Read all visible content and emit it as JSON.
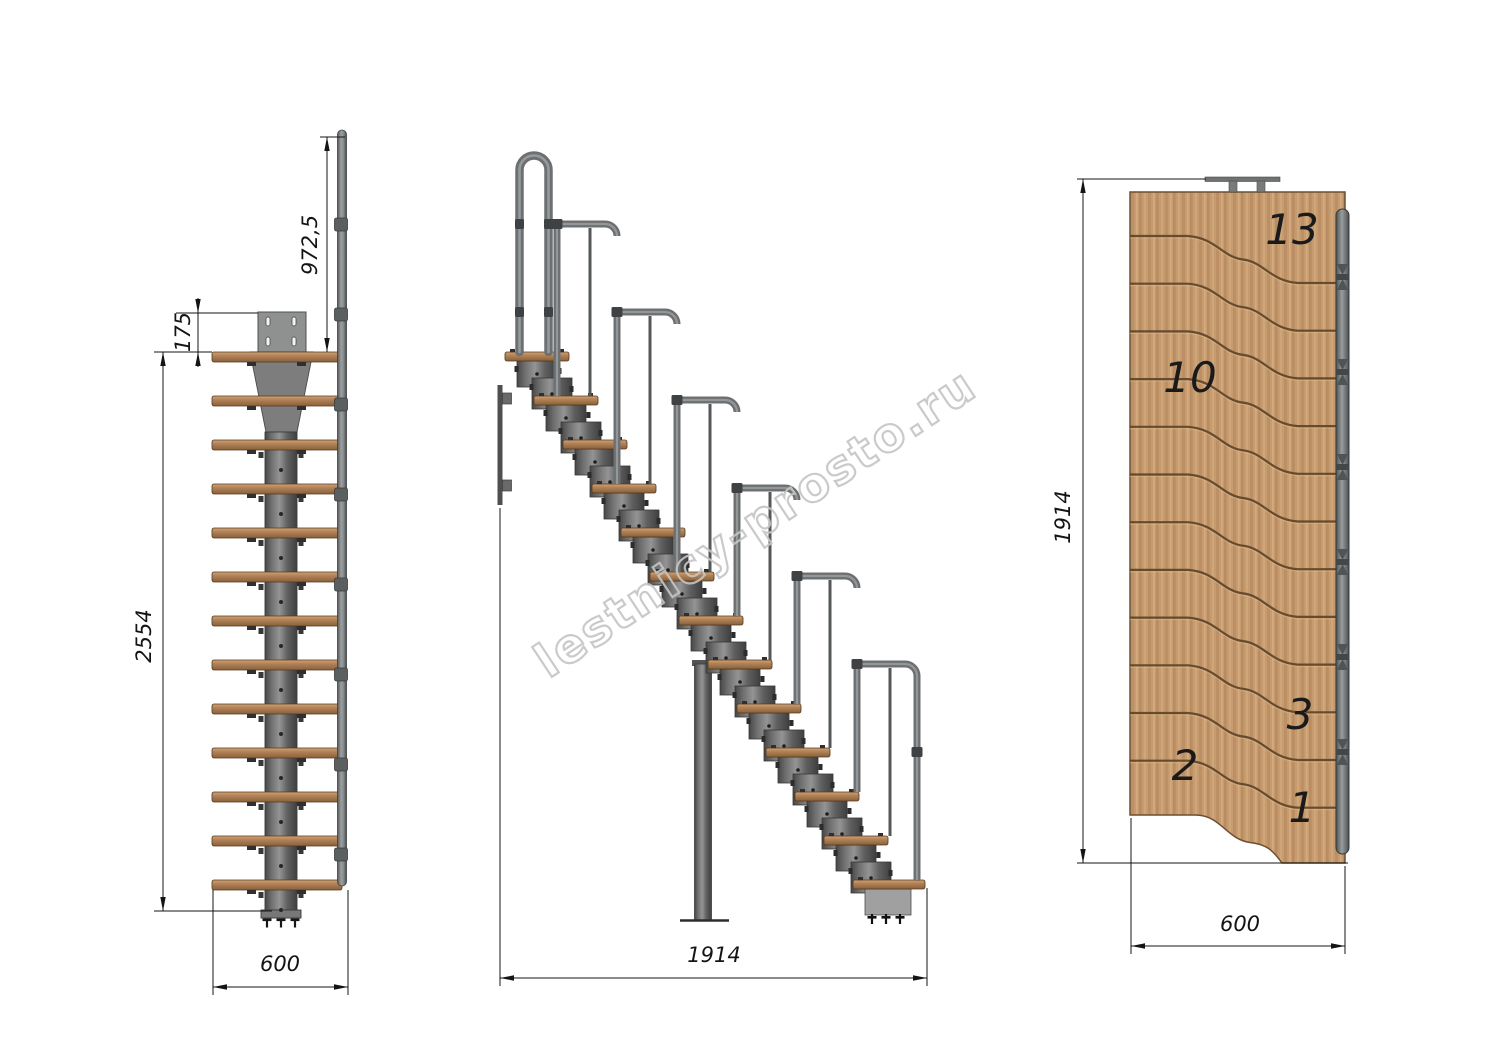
{
  "watermark": "lestnicy-prosto.ru",
  "structure": {
    "steps": 13,
    "handrail_joints": 6
  },
  "front_view": {
    "dim_handrail_height": "972,5",
    "dim_top_module": "175",
    "dim_total_height": "2554",
    "dim_width": "600"
  },
  "side_view": {
    "dim_length": "1914"
  },
  "plan_view": {
    "dim_length": "1914",
    "dim_width": "600",
    "step_labels": [
      "13",
      "10",
      "3",
      "2",
      "1"
    ]
  }
}
